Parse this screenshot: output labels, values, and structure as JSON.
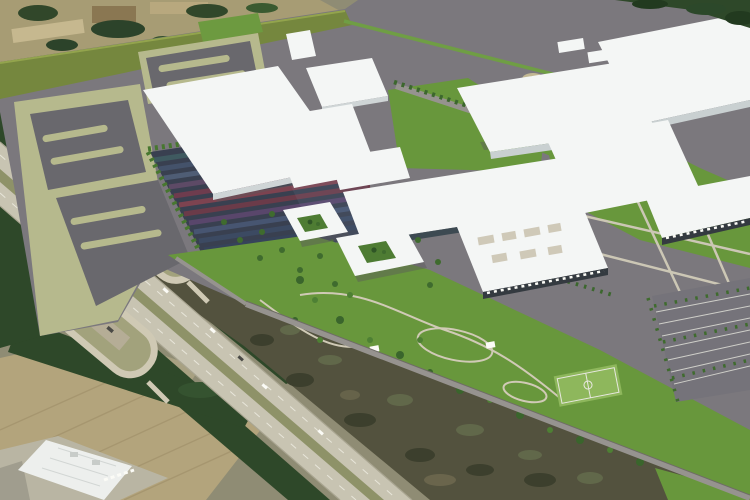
{
  "image": {
    "kind": "aerial-architectural-rendering",
    "description": "Bird's-eye master-plan rendering of a large manufacturing campus: white flat-roofed factory buildings, gray parking fields framed in sage-green paving, a striped solar panel array, two white courtyard office buildings, landscaped park with winding trails and a basketball court, tree-lined entry road and employee parking rows. The rendered site is composited onto aerial photography showing a divided interstate highway with twin rest-area loop ramps, dark pine tree lines, tan farm fields, scrub forest, and an existing white warehouse at lower left.",
    "width_px": 750,
    "height_px": 500
  },
  "palette": {
    "bgOlive": "#8f8c74",
    "photoFieldTan": "#a79c74",
    "photoPaleTan": "#c6b88f",
    "fieldBottom": "#b3a47c",
    "forestDark": "#2e4829",
    "scrub": "#53523e",
    "highwayConcrete": "#c8c4b2",
    "medianGreen": "#8e9268",
    "loopPavement": "#cfc9b4",
    "campusPavement": "#7b787d",
    "lotGray": "#69686d",
    "sage": "#b6b98d",
    "oliveBand": "#75873e",
    "lawnGreen": "#68973c",
    "treeGreen": "#3f6b2e",
    "roofWhite": "#f4f6f5",
    "roofShade": "#d6dbdc",
    "solarBase": "#394050",
    "courtyardGreen": "#4e7c33",
    "roadGray": "#96938f",
    "dockDark": "#343a40",
    "courtGreen": "#8eb75c",
    "pathLight": "#cfc9b6"
  },
  "regions": [
    {
      "id": "terrain-photo",
      "label": "surrounding aerial-photo terrain of fields and woods"
    },
    {
      "id": "top-left-farmland",
      "label": "mottled farmland and tree clumps, upper left"
    },
    {
      "id": "interstate-highway",
      "label": "divided interstate highway crossing lower left"
    },
    {
      "id": "rest-area-loops",
      "label": "two rest-area / weigh-station loop ramps beside highway"
    },
    {
      "id": "existing-warehouse",
      "label": "existing white warehouse with loading docks, bottom left"
    },
    {
      "id": "scrub-forest",
      "label": "scrub forest wedge between highway and campus"
    },
    {
      "id": "campus",
      "label": "rendered manufacturing campus site"
    },
    {
      "id": "olive-buffer",
      "label": "olive-green landscape buffer along rear site edge"
    },
    {
      "id": "sage-parking-fields",
      "label": "sage-framed gray parking fields, west side"
    },
    {
      "id": "solar-array",
      "label": "striped solar panel array"
    },
    {
      "id": "factory-buildings",
      "label": "white flat-roofed factory and logistics buildings"
    },
    {
      "id": "courtyard-offices",
      "label": "two white courtyard office buildings with planted atria"
    },
    {
      "id": "entry-road",
      "label": "tree-lined entry road"
    },
    {
      "id": "amenity-park",
      "label": "landscaped park with winding trails"
    },
    {
      "id": "basketball-court",
      "label": "basketball court in park"
    },
    {
      "id": "employee-parking",
      "label": "striped employee parking rows with trees, east side"
    },
    {
      "id": "boundary-road",
      "label": "site boundary road running to lower right corner"
    }
  ]
}
